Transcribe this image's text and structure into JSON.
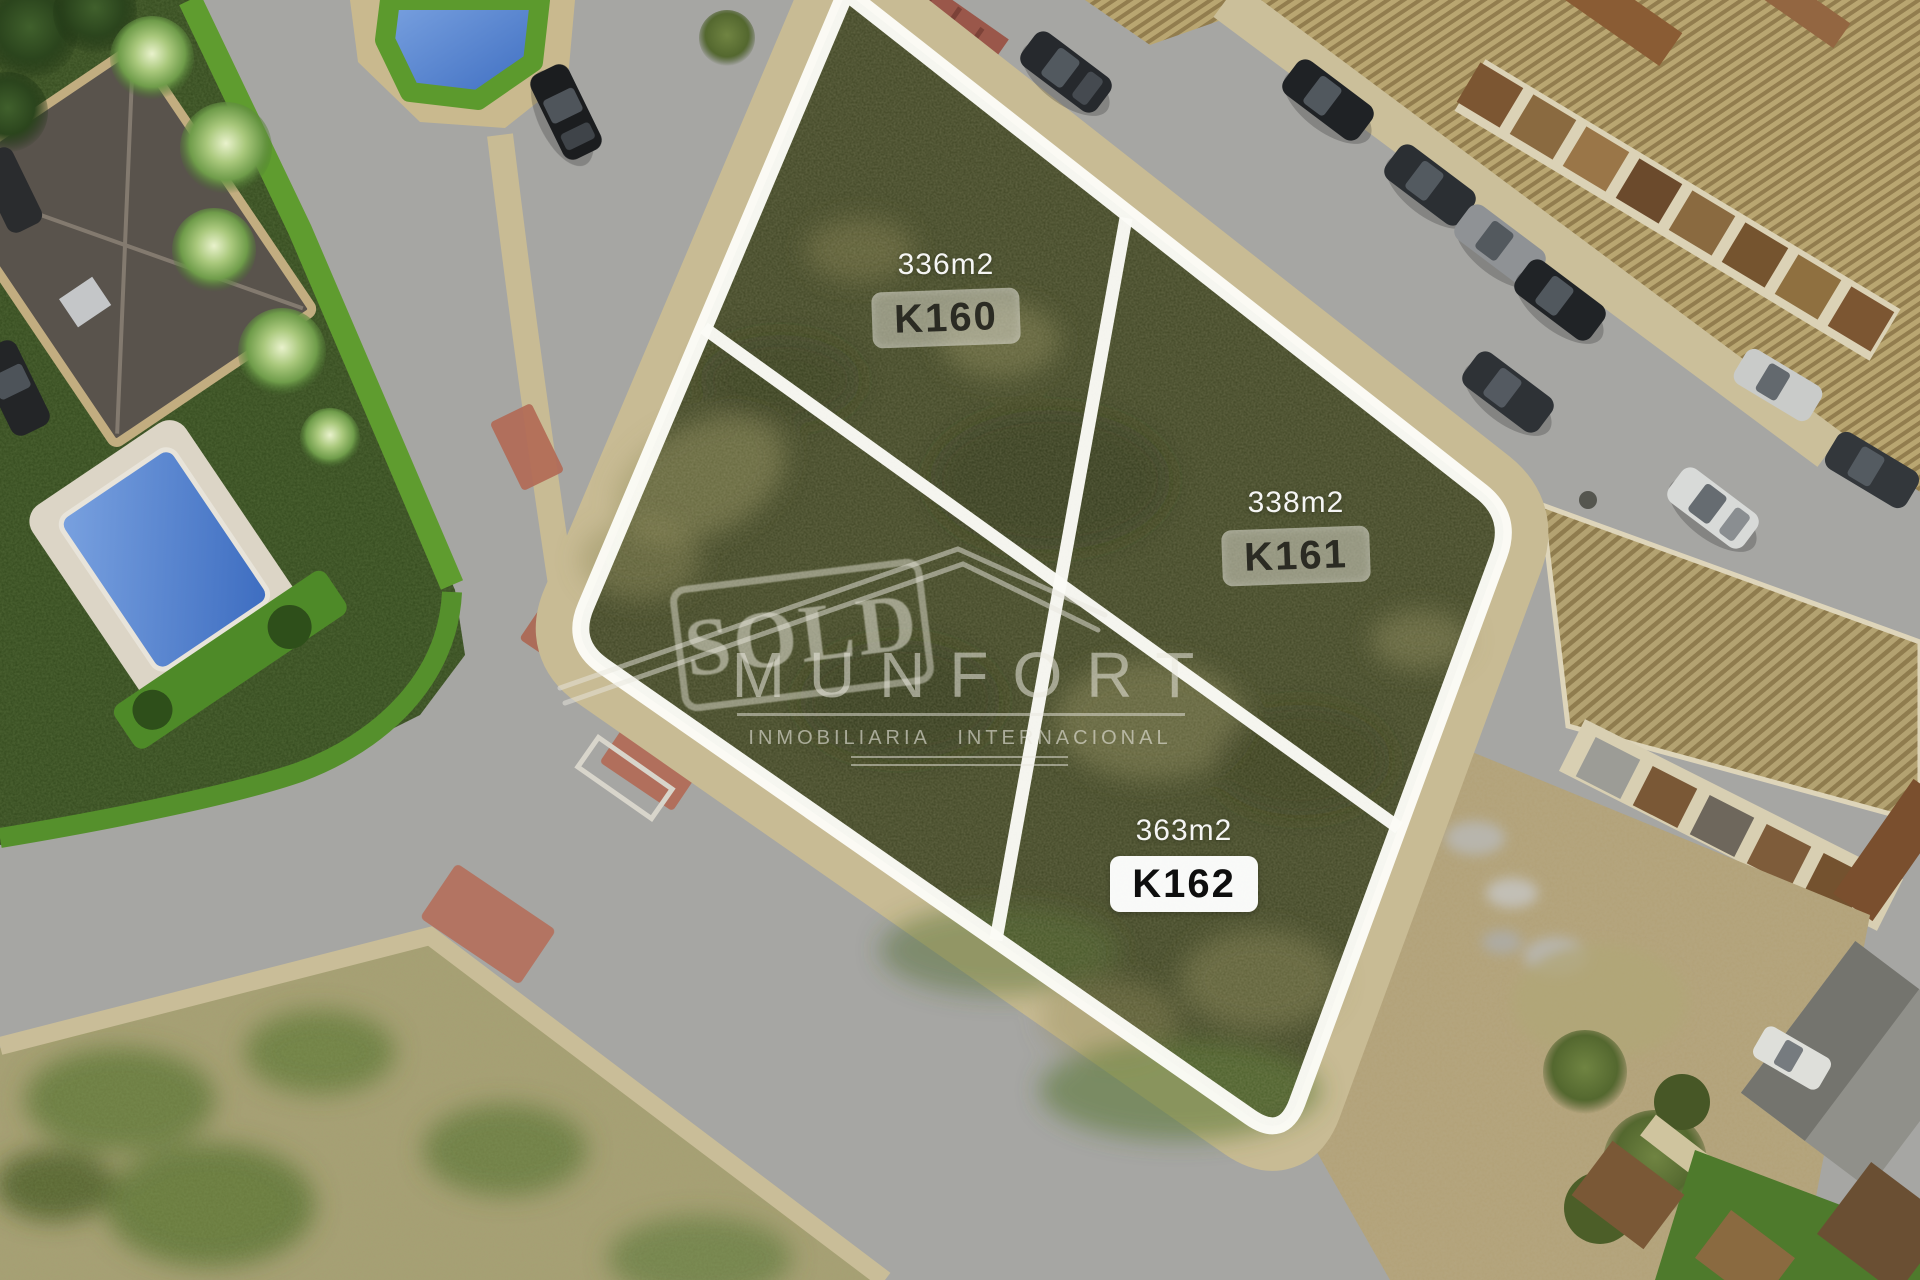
{
  "plots": {
    "k160": {
      "area": "336m2",
      "code": "K160"
    },
    "k161": {
      "area": "338m2",
      "code": "K161"
    },
    "k162": {
      "area": "363m2",
      "code": "K162"
    }
  },
  "watermark": {
    "stamp": "SOLD",
    "brand": "MUNFORT",
    "tagline": "INMOBILIARIA INTERNACIONAL"
  },
  "colors": {
    "plot_line_white": "#fcfcf7",
    "field_green": "#3f4524",
    "road_gray": "#a6a6a3",
    "sidewalk_tan": "#c8bb94",
    "pool_blue": "#4a7dc8",
    "hedge_green": "#5f9c2f",
    "roof_tan": "#b6a26b",
    "badge_gray_bg": "rgba(211,209,197,0.55)",
    "badge_white_bg": "#ffffff",
    "watermark_white": "rgba(233,231,223,0.55)",
    "crosswalk_red": "#b26a56"
  }
}
